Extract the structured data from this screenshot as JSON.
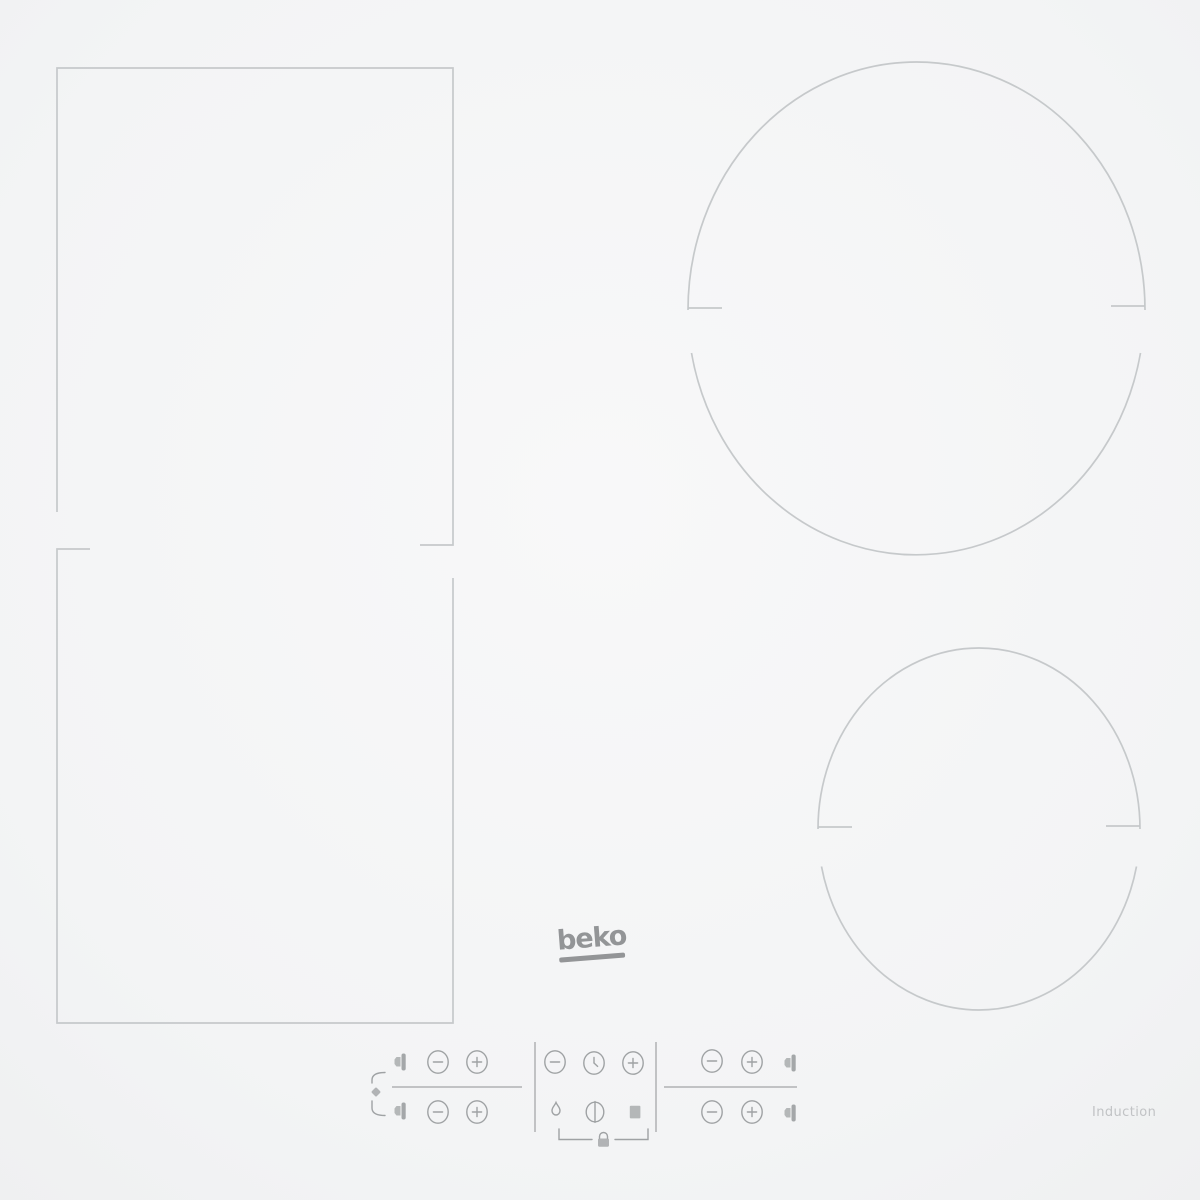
{
  "brand": {
    "logo_text": "beko"
  },
  "surface": {
    "type_label": "Induction"
  },
  "colors": {
    "surface_center": "#f8f8f9",
    "surface_edge": "#e6e7e9",
    "zone_outline": "#c3c6c8",
    "control_icon": "#9fa2a4",
    "divider": "#b7b9bb",
    "logo": "#939597",
    "type_label_text": "#c1c3c5"
  },
  "zones": [
    {
      "name": "flexi-zone-upper",
      "shape": "rectangle",
      "position": "top-left"
    },
    {
      "name": "flexi-zone-lower",
      "shape": "rectangle",
      "position": "bottom-left"
    },
    {
      "name": "cooking-zone-large",
      "shape": "circle",
      "position": "top-right"
    },
    {
      "name": "cooking-zone-small",
      "shape": "circle",
      "position": "bottom-right"
    }
  ],
  "controls": {
    "left_group": {
      "link_indicator": "flexi-link-bracket",
      "rows": [
        [
          "zone-indicator-icon",
          "minus-button",
          "plus-button"
        ],
        [
          "zone-indicator-icon",
          "minus-button",
          "plus-button"
        ]
      ]
    },
    "center_group": {
      "top_row": [
        "minus-button",
        "timer-button",
        "plus-button"
      ],
      "bottom_row": [
        "boost-button",
        "power-button",
        "pause-button"
      ],
      "below": "key-lock-button"
    },
    "right_group": {
      "rows": [
        [
          "minus-button",
          "plus-button",
          "zone-indicator-icon"
        ],
        [
          "minus-button",
          "plus-button",
          "zone-indicator-icon"
        ]
      ]
    }
  }
}
